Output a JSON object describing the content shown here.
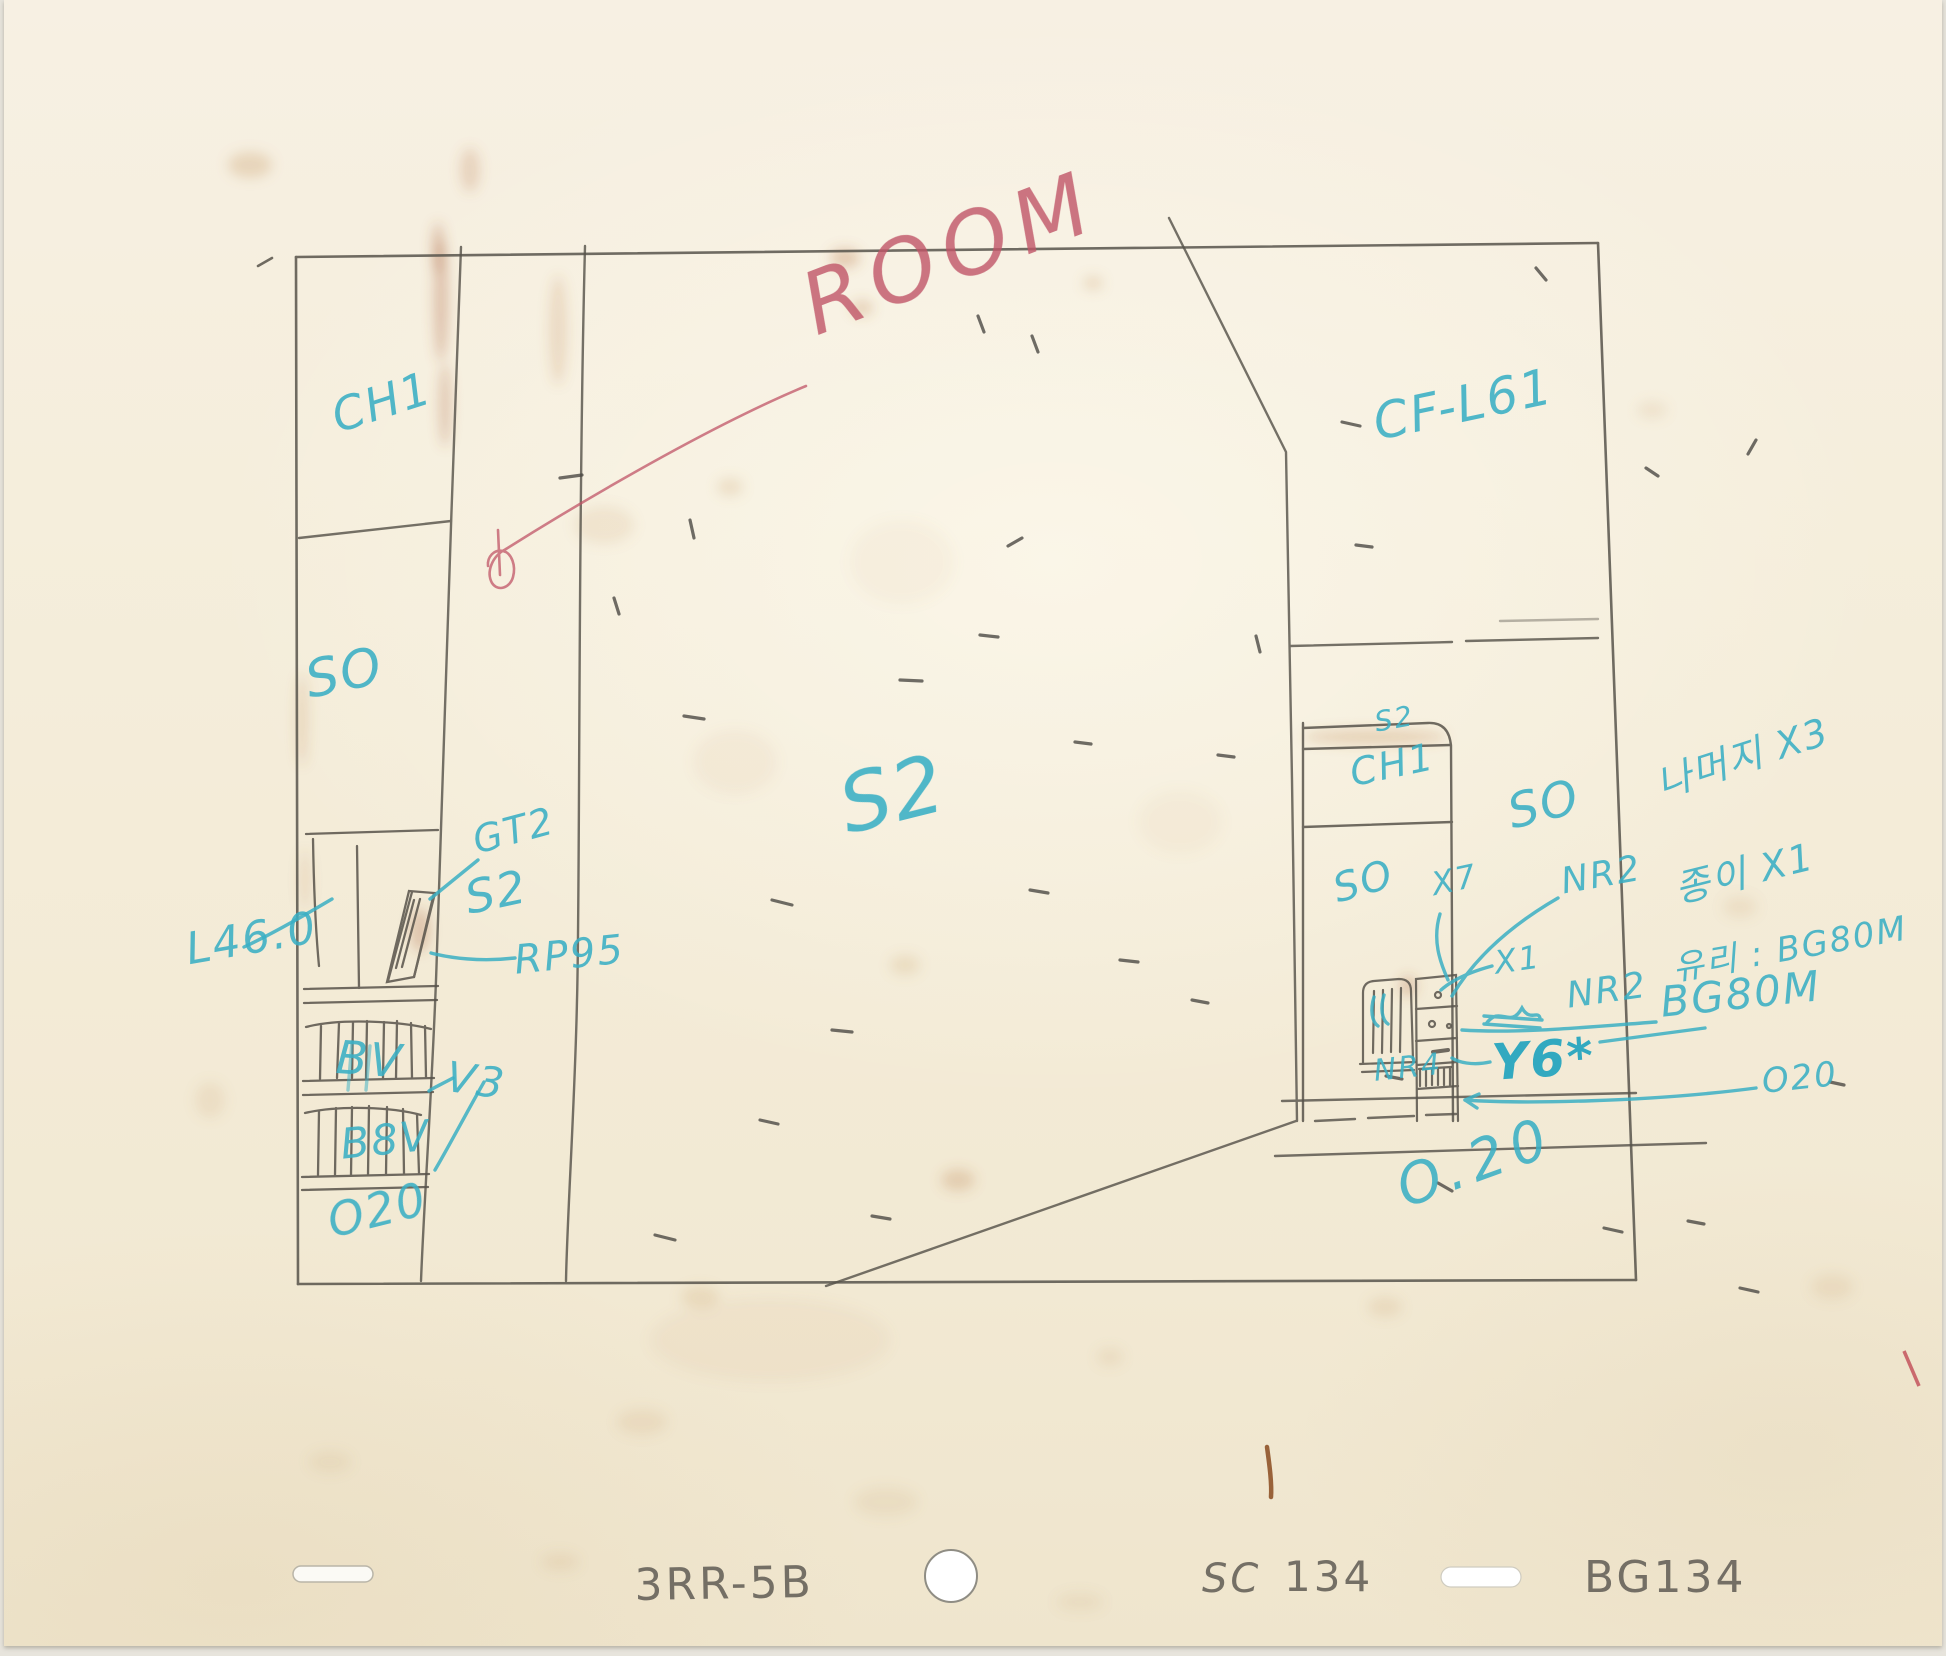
{
  "page": {
    "width": 1946,
    "height": 1656,
    "description_colors": {
      "paper": "#f5eedc",
      "pencil": "#57534b",
      "blue_pencil": "#3aafc4",
      "red_pencil": "#c05467",
      "stain_rust": "#a9613a"
    }
  },
  "sketch": {
    "red_note": {
      "room": "ROOM"
    },
    "labels": {
      "ch1_left": "CH1",
      "so_left": "SO",
      "l46": "L46.0",
      "gt2": "GT2",
      "s2_shelf": "S2",
      "rp95": "RP95",
      "bv_books": "BV",
      "v3": "V3",
      "b8v": "B8V",
      "o20_shelf": "O20",
      "s2_wall": "S2",
      "cfl61": "CF-L61",
      "s2_door": "S2",
      "ch1_door": "CH1",
      "so_wall": "SO",
      "so_door": "SO",
      "x7": "X7",
      "nr2_upper": "NR2",
      "korean_1": "나머지 X3",
      "korean_2": "종이 X1",
      "korean_3": "유리 : BG80M",
      "x1": "X1",
      "nr2_lower": "NR2",
      "bg80m": "BG80M",
      "y6": "Y6*",
      "nr4": "NR4",
      "o20_floor_small": "O20",
      "o20_floor_big": "O.20"
    }
  },
  "footer": {
    "episode_code": "3RR-5B",
    "sc_label": "SC",
    "scene_number": "134",
    "bg_number": "BG134"
  }
}
